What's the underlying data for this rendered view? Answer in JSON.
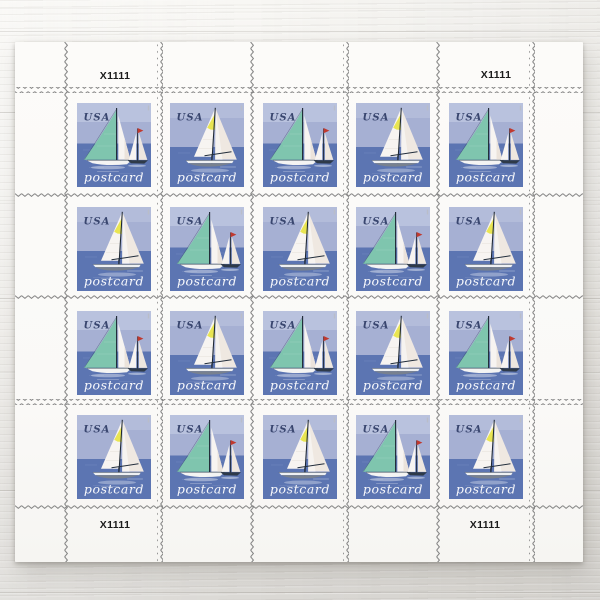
{
  "sheet": {
    "plate_number": "X1111",
    "plate_number_positions": [
      "top-left",
      "top-right",
      "bottom-left",
      "bottom-right"
    ],
    "grid": {
      "rows": 4,
      "cols": 5,
      "total_stamps": 20
    },
    "stamp": {
      "country_label": "USA",
      "denomination_label": "postcard",
      "designs": {
        "A": "two sailboats, large teal mainsail, small boat with red pennant",
        "B": "single sailboat with yellow panel on jib and gray hull"
      }
    },
    "layout": [
      "A",
      "B",
      "A",
      "B",
      "A",
      "B",
      "A",
      "B",
      "A",
      "B",
      "A",
      "B",
      "A",
      "B",
      "A",
      "B",
      "A",
      "B",
      "A",
      "B"
    ],
    "colors": {
      "sky": "#a6b0d3",
      "sky_light": "#b9c2de",
      "sea": "#5c75b2",
      "sail_teal": "#7fc5ae",
      "sail_yellow": "#e9e552",
      "pennant_red": "#c0392f",
      "sail_white": "#f7f4f1",
      "perforation": "#818181",
      "sheet_white": "#fbfaf8"
    }
  }
}
